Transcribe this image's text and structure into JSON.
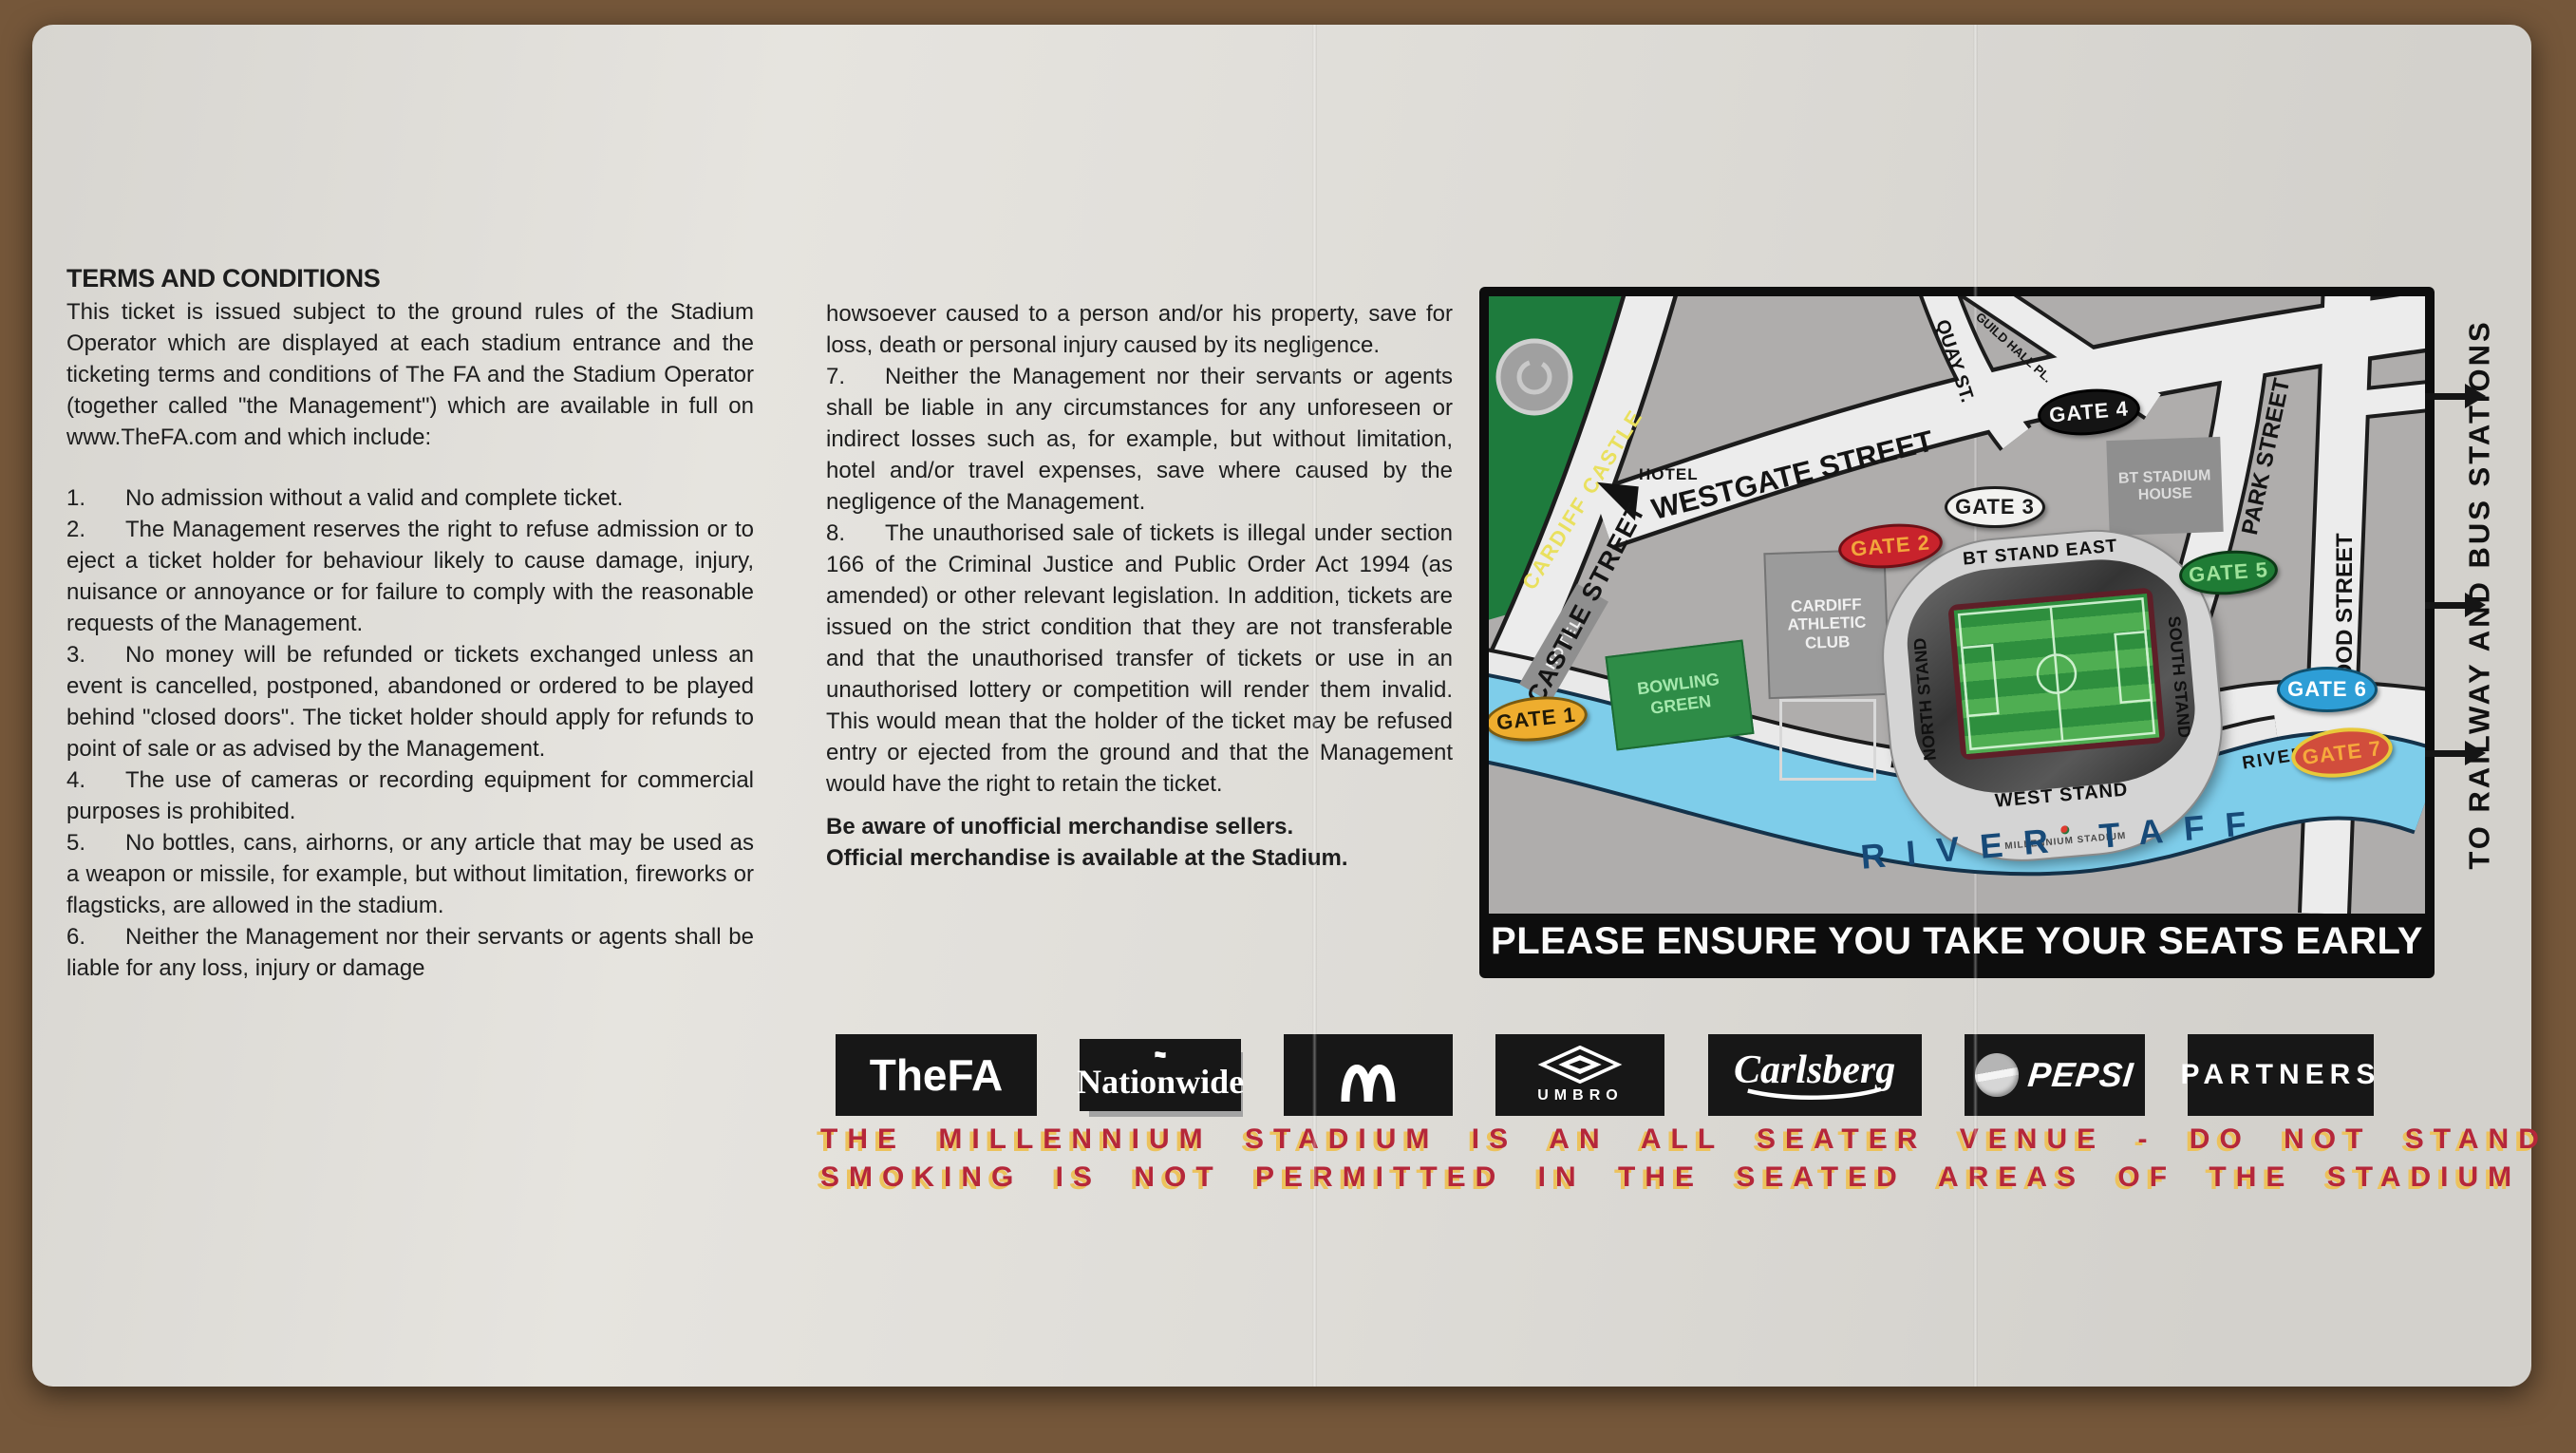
{
  "terms": {
    "heading": "TERMS AND CONDITIONS",
    "intro": "This ticket is issued subject to the ground rules of the Stadium Operator which are displayed at each stadium entrance and the ticketing terms and conditions of The FA and the Stadium Operator (together called \"the Management\") which are available in full on www.TheFA.com and which include:",
    "items": [
      {
        "num": "1.",
        "text": "No admission without a valid and complete ticket."
      },
      {
        "num": "2.",
        "text": "The Management reserves the right to refuse admission or to eject a ticket holder for behaviour likely to cause damage, injury, nuisance or annoyance or for failure to comply with the reasonable requests of the Management."
      },
      {
        "num": "3.",
        "text": "No money will be refunded or tickets exchanged unless an event is cancelled, postponed, abandoned or ordered to be played behind \"closed doors\". The ticket holder should apply for refunds to point of sale or as advised by the Management."
      },
      {
        "num": "4.",
        "text": "The use of cameras or recording equipment for commercial purposes is prohibited."
      },
      {
        "num": "5.",
        "text": "No bottles, cans, airhorns, or any article that may be used as a weapon or missile, for example, but without limitation, fireworks or flagsticks, are allowed in the stadium."
      },
      {
        "num": "6.",
        "text": "Neither the Management nor their servants or agents shall be liable for any loss, injury or damage"
      }
    ],
    "item6_continuation": "howsoever caused to a person and/or his property, save for loss, death or personal injury caused by its negligence.",
    "items2": [
      {
        "num": "7.",
        "text": "Neither the Management nor their servants or agents shall be liable in any circumstances for any unforeseen or indirect losses such as, for example, but without limitation, hotel and/or travel expenses, save where caused by the negligence of the Management."
      },
      {
        "num": "8.",
        "text": "The unauthorised sale of tickets is illegal under section 166 of the Criminal Justice and Public Order Act 1994 (as amended) or other relevant legislation. In addition, tickets are issued on the strict condition that they are not transferable and that the unauthorised transfer of tickets or use in an unauthorised lottery or competition will render them invalid. This would mean that the holder of the ticket may be refused entry or ejected from the ground and that the Management would have the right to retain the ticket."
      }
    ],
    "merch1": "Be aware of unofficial merchandise sellers.",
    "merch2": "Official merchandise is available at the Stadium."
  },
  "map": {
    "labels": {
      "cardiff_castle": "CARDIFF CASTLE",
      "castle_street": "CASTLE STREET",
      "westgate_street": "WESTGATE STREET",
      "quay_st": "QUAY ST.",
      "guild_hall_pl": "GUILD HALL PL.",
      "park_street": "PARK STREET",
      "wood_street": "WOOD STREET",
      "hotel_west": "HOTEL",
      "hotel_castle": "HOTEL",
      "cardiff_athletic_club": "CARDIFF ATHLETIC CLUB",
      "bt_stadium_house": "BT STADIUM HOUSE",
      "bowling_green": "BOWLING GREEN",
      "river_walk_left": "RIVER WALK",
      "river_walk_right": "RIVER WALK",
      "river_taff": "RIVER TAFF",
      "bt_stand_east": "BT STAND EAST",
      "north_stand": "NORTH STAND",
      "south_stand": "SOUTH STAND",
      "west_stand": "WEST STAND",
      "millennium_stadium": "MILLENNIUM STADIUM"
    },
    "gates": [
      {
        "label": "GATE 1",
        "bg": "#eead2e",
        "fg": "#211a08",
        "border": "#7a5a10"
      },
      {
        "label": "GATE 2",
        "bg": "#c8232c",
        "fg": "#f2a63c",
        "border": "#6e1016"
      },
      {
        "label": "GATE 3",
        "bg": "#f2f2f0",
        "fg": "#1a1a1a",
        "border": "#1a1a1a"
      },
      {
        "label": "GATE 4",
        "bg": "#141414",
        "fg": "#f5f5f5",
        "border": "#000000"
      },
      {
        "label": "GATE 5",
        "bg": "#1f7c35",
        "fg": "#9fe29b",
        "border": "#0c3a17"
      },
      {
        "label": "GATE 6",
        "bg": "#2e9ed6",
        "fg": "#ffffff",
        "border": "#10506e"
      },
      {
        "label": "GATE 7",
        "bg": "#d14d3c",
        "fg": "#f6a93c",
        "border": "#e8c93a"
      }
    ],
    "notice": "PLEASE ENSURE YOU TAKE YOUR SEATS EARLY",
    "to_stations": "TO RAILWAY AND BUS STATIONS"
  },
  "sponsors": [
    {
      "name": "the-fa",
      "label": "TheFA"
    },
    {
      "name": "nationwide",
      "label": "Nationwide",
      "icon": "nationwide-emblem-icon"
    },
    {
      "name": "mcdonalds",
      "icon": "golden-arches-icon"
    },
    {
      "name": "umbro",
      "label": "UMBRO",
      "icon": "umbro-diamond-icon"
    },
    {
      "name": "carlsberg",
      "label": "Carlsberg"
    },
    {
      "name": "pepsi",
      "label": "PEPSI",
      "icon": "pepsi-globe-icon"
    },
    {
      "name": "partners",
      "label": "PARTNERS"
    }
  ],
  "footer": {
    "line1": "THE MILLENNIUM STADIUM IS AN ALL SEATER VENUE - DO NOT STAND",
    "line2": "SMOKING IS NOT PERMITTED IN THE SEATED AREAS OF THE STADIUM"
  }
}
